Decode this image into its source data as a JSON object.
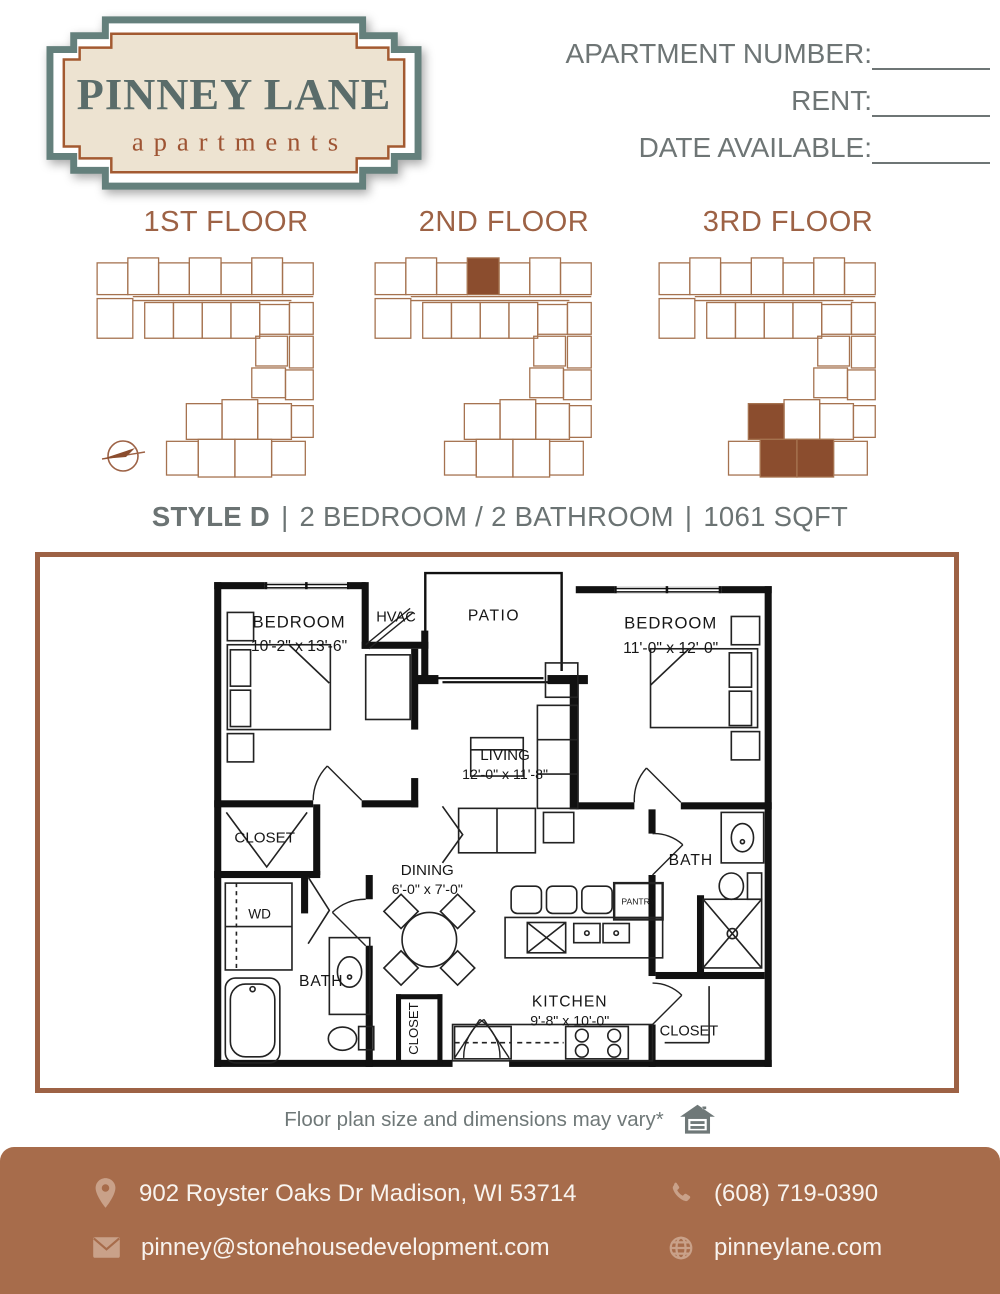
{
  "brand": {
    "name": "PINNEY LANE",
    "subtitle": "apartments"
  },
  "header_fields": {
    "apartment_number": "APARTMENT NUMBER:",
    "rent": "RENT:",
    "date_available": "DATE AVAILABLE:"
  },
  "floors": {
    "first": "1ST FLOOR",
    "second": "2ND FLOOR",
    "third": "3RD FLOOR"
  },
  "style_line": {
    "style": "STYLE D",
    "separator": "|",
    "bed_bath": "2 BEDROOM / 2 BATHROOM",
    "sqft": "1061 SQFT"
  },
  "plan": {
    "bedroom1": "BEDROOM",
    "bedroom1_dims": "10'-2\" x 13'-6\"",
    "hvac": "HVAC",
    "patio": "PATIO",
    "bedroom2": "BEDROOM",
    "bedroom2_dims": "11'-0\" x 12'-0\"",
    "living": "LIVING",
    "living_dims": "12'-0\" x 11'-8\"",
    "closet_bedroom1": "CLOSET",
    "wd": "WD",
    "bath1": "BATH",
    "dining": "DINING",
    "dining_dims": "6'-0\" x 7'-0\"",
    "entry_closet": "CLOSET",
    "kitchen": "KITCHEN",
    "kitchen_dims": "9'-8\" x 10'-0\"",
    "pantry": "PANTRY",
    "bath2": "BATH",
    "closet_bedroom2": "CLOSET"
  },
  "disclaimer": "Floor plan size and dimensions may vary*",
  "footer": {
    "address": "902 Royster Oaks Dr Madison, WI 53714",
    "phone": "(608) 719-0390",
    "email": "pinney@stonehousedevelopment.com",
    "website": "pinneylane.com"
  },
  "icons": {
    "location": "map-pin-icon",
    "phone": "phone-icon",
    "email": "envelope-icon",
    "website": "globe-icon",
    "equal_housing": "equal-housing-icon",
    "compass": "compass-icon"
  },
  "colors": {
    "accent_brown": "#9D6245",
    "footer_background": "#A76C4B",
    "footer_icon_tan": "#C9A189",
    "logo_slate": "#5A6C6A",
    "logo_rust": "#A35A31",
    "logo_cream": "#EDE3D1",
    "highlight_unit": "#8B4D2E",
    "text_gray": "#6B7373"
  }
}
